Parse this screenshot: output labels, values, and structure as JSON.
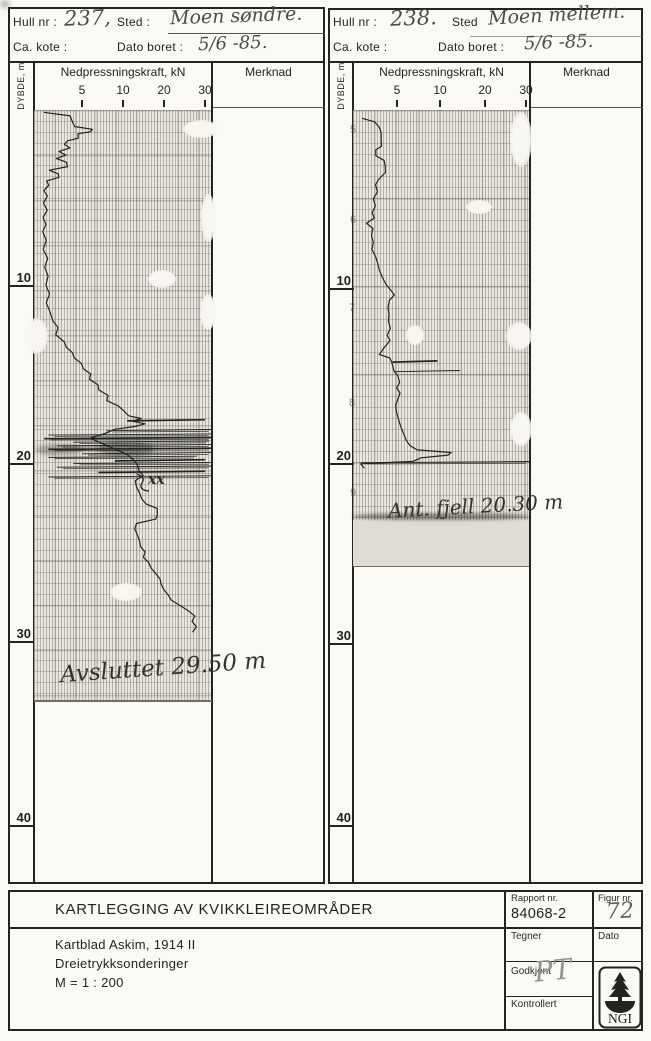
{
  "document": {
    "panels": [
      {
        "hull_label": "Hull nr :",
        "hull_value": "237,",
        "sted_label": "Sted :",
        "sted_value": "Moen søndre.",
        "kote_label": "Ca. kote :",
        "dato_label": "Dato boret :",
        "dato_value": "5/6 -85.",
        "depth_col_label": "DYBDE, m",
        "force_header": "Nedpressningskraft, kN",
        "merknad_header": "Merknad",
        "force_ticks": [
          "5",
          "10",
          "20",
          "30"
        ],
        "depth_labels": [
          "10",
          "20",
          "30",
          "40"
        ],
        "note": "xx",
        "end_annotation": "Avsluttet 29.50 m"
      },
      {
        "hull_label": "Hull nr :",
        "hull_value": "238.",
        "sted_label": "Sted",
        "sted_value": "Moen mellem.",
        "kote_label": "Ca. kote :",
        "dato_label": "Dato boret :",
        "dato_value": "5/6 -85.",
        "depth_col_label": "DYBDE, m",
        "force_header": "Nedpressningskraft, kN",
        "merknad_header": "Merknad",
        "force_ticks": [
          "5",
          "10",
          "20",
          "30"
        ],
        "depth_labels": [
          "10",
          "20",
          "30",
          "40"
        ],
        "paper_marks": [
          "5",
          "6",
          "7",
          "8",
          "9"
        ],
        "end_annotation": "Ant. fjell 20.30 m"
      }
    ],
    "title_block": {
      "title": "KARTLEGGING AV KVIKKLEIREOMRÅDER",
      "lines": [
        "Kartblad Askim, 1914 II",
        "Dreietrykksonderinger",
        "M = 1 : 200"
      ],
      "rapport_label": "Rapport nr.",
      "rapport_nr": "84068-2",
      "figur_label": "Figur nr.",
      "figur_nr": "72",
      "tegner_label": "Tegner",
      "dato_label": "Dato",
      "godkjent_label": "Godkjent",
      "godkjent_sign": "PT",
      "kontrollert_label": "Kontrollert",
      "logo_text": "NGI"
    }
  },
  "chart_data": [
    {
      "type": "line",
      "title": "Dreietrykksondering hull 237, Moen søndre",
      "xlabel": "Nedpressningskraft, kN",
      "ylabel": "Dybde, m",
      "x_ticks": [
        5,
        10,
        20,
        30
      ],
      "x_scale_note": "segmented scale, ticks 5/10/20/30 equally spaced",
      "depth_ticks": [
        10,
        20,
        30,
        40
      ],
      "ylim": [
        0,
        45
      ],
      "end_depth_m": 29.5,
      "end_note": "Avsluttet 29.50 m",
      "depth_m_force_kN": [
        [
          0.3,
          0.5
        ],
        [
          0.5,
          3.6
        ],
        [
          0.9,
          3.9
        ],
        [
          1.1,
          4.1
        ],
        [
          1.25,
          6.3
        ],
        [
          1.4,
          6.0
        ],
        [
          1.5,
          4.5
        ],
        [
          1.75,
          4.6
        ],
        [
          1.9,
          3.3
        ],
        [
          2.1,
          2.9
        ],
        [
          2.3,
          3.5
        ],
        [
          2.5,
          2.3
        ],
        [
          2.7,
          3.1
        ],
        [
          2.9,
          1.9
        ],
        [
          3.1,
          3.2
        ],
        [
          3.35,
          3.3
        ],
        [
          3.55,
          1.1
        ],
        [
          3.75,
          2.1
        ],
        [
          3.95,
          2.3
        ],
        [
          4.15,
          0.8
        ],
        [
          4.4,
          1.0
        ],
        [
          4.7,
          0.5
        ],
        [
          5.0,
          0.9
        ],
        [
          5.4,
          0.4
        ],
        [
          5.8,
          0.8
        ],
        [
          6.2,
          0.4
        ],
        [
          6.6,
          0.7
        ],
        [
          7.0,
          0.3
        ],
        [
          7.5,
          0.8
        ],
        [
          8.0,
          0.4
        ],
        [
          8.5,
          0.9
        ],
        [
          9.0,
          0.5
        ],
        [
          9.5,
          1.0
        ],
        [
          10.0,
          0.7
        ],
        [
          10.5,
          1.1
        ],
        [
          11.0,
          0.8
        ],
        [
          11.5,
          1.2
        ],
        [
          12.0,
          1.5
        ],
        [
          12.4,
          2.1
        ],
        [
          12.8,
          1.9
        ],
        [
          13.2,
          2.9
        ],
        [
          13.5,
          3.1
        ],
        [
          13.8,
          3.9
        ],
        [
          14.1,
          4.1
        ],
        [
          14.4,
          4.9
        ],
        [
          14.7,
          5.1
        ],
        [
          15.0,
          6.1
        ],
        [
          15.3,
          5.9
        ],
        [
          15.6,
          6.9
        ],
        [
          15.9,
          7.1
        ],
        [
          16.2,
          8.2
        ],
        [
          16.5,
          8.0
        ],
        [
          16.8,
          9.4
        ],
        [
          17.1,
          10.4
        ],
        [
          17.35,
          11.4
        ],
        [
          17.5,
          14.4
        ],
        [
          17.65,
          12.4
        ],
        [
          17.8,
          15.4
        ],
        [
          17.95,
          12.9
        ],
        [
          18.1,
          9.0
        ],
        [
          18.35,
          7.8
        ],
        [
          18.6,
          6.0
        ],
        [
          18.9,
          7.4
        ],
        [
          19.2,
          9.0
        ],
        [
          19.5,
          10.9
        ],
        [
          19.8,
          12.4
        ],
        [
          20.1,
          13.4
        ],
        [
          20.4,
          13.9
        ],
        [
          20.7,
          14.9
        ],
        [
          21.0,
          12.9
        ],
        [
          21.35,
          13.4
        ],
        [
          21.7,
          14.1
        ],
        [
          22.0,
          14.5
        ],
        [
          22.3,
          15.5
        ],
        [
          22.55,
          18.4
        ],
        [
          22.9,
          18.4
        ],
        [
          23.15,
          17.9
        ],
        [
          23.4,
          13.4
        ],
        [
          23.7,
          12.9
        ],
        [
          24.0,
          13.4
        ],
        [
          24.35,
          13.9
        ],
        [
          24.7,
          14.4
        ],
        [
          25.0,
          15.4
        ],
        [
          25.3,
          14.9
        ],
        [
          25.6,
          16.4
        ],
        [
          25.9,
          16.9
        ],
        [
          26.2,
          17.9
        ],
        [
          26.5,
          18.9
        ],
        [
          26.8,
          19.4
        ],
        [
          27.1,
          19.9
        ],
        [
          27.4,
          20.9
        ],
        [
          27.7,
          21.9
        ],
        [
          28.0,
          23.9
        ],
        [
          28.3,
          25.9
        ],
        [
          28.6,
          27.4
        ],
        [
          28.9,
          26.9
        ],
        [
          29.2,
          27.9
        ],
        [
          29.5,
          26.9
        ]
      ],
      "offscale_spikes": [
        [
          17.6,
          11,
          30
        ],
        [
          18.15,
          8,
          44
        ],
        [
          18.4,
          1,
          40
        ],
        [
          18.6,
          0.5,
          38
        ],
        [
          18.8,
          4,
          31
        ],
        [
          19.0,
          2,
          36
        ],
        [
          19.2,
          1,
          34
        ],
        [
          19.45,
          5,
          33
        ],
        [
          19.65,
          1,
          28
        ],
        [
          19.85,
          9,
          30
        ],
        [
          20.0,
          4,
          36
        ],
        [
          20.2,
          2,
          40
        ],
        [
          20.5,
          7,
          30
        ],
        [
          20.75,
          1,
          37
        ]
      ]
    },
    {
      "type": "line",
      "title": "Dreietrykksondering hull 238, Moen mellem",
      "xlabel": "Nedpressningskraft, kN",
      "ylabel": "Dybde, m",
      "x_ticks": [
        5,
        10,
        20,
        30
      ],
      "x_scale_note": "segmented scale, ticks 5/10/20/30 equally spaced",
      "depth_ticks": [
        10,
        20,
        30,
        40
      ],
      "ylim": [
        0,
        45
      ],
      "end_depth_m": 20.3,
      "end_note": "Ant. fjell 20.30 m",
      "depth_m_force_kN": [
        [
          0.3,
          1.0
        ],
        [
          0.5,
          2.4
        ],
        [
          0.8,
          2.9
        ],
        [
          1.1,
          3.1
        ],
        [
          1.5,
          3.2
        ],
        [
          1.9,
          3.2
        ],
        [
          2.1,
          2.5
        ],
        [
          2.45,
          2.6
        ],
        [
          2.7,
          3.5
        ],
        [
          3.0,
          3.6
        ],
        [
          3.4,
          3.6
        ],
        [
          3.8,
          2.9
        ],
        [
          4.1,
          2.5
        ],
        [
          4.5,
          2.7
        ],
        [
          4.9,
          2.3
        ],
        [
          5.3,
          2.5
        ],
        [
          5.7,
          2.1
        ],
        [
          6.0,
          2.3
        ],
        [
          6.3,
          1.5
        ],
        [
          6.6,
          2.2
        ],
        [
          7.0,
          2.0
        ],
        [
          7.4,
          2.3
        ],
        [
          7.8,
          2.1
        ],
        [
          8.2,
          2.5
        ],
        [
          8.6,
          2.7
        ],
        [
          9.0,
          3.0
        ],
        [
          9.4,
          3.3
        ],
        [
          9.8,
          3.7
        ],
        [
          10.1,
          4.3
        ],
        [
          10.4,
          4.7
        ],
        [
          10.7,
          4.1
        ],
        [
          11.1,
          3.9
        ],
        [
          11.5,
          4.1
        ],
        [
          11.9,
          4.0
        ],
        [
          12.3,
          4.2
        ],
        [
          12.7,
          3.9
        ],
        [
          13.0,
          4.2
        ],
        [
          13.4,
          3.5
        ],
        [
          13.8,
          2.9
        ],
        [
          14.0,
          4.2
        ],
        [
          14.25,
          4.4
        ],
        [
          14.5,
          4.5
        ],
        [
          14.75,
          4.7
        ],
        [
          15.0,
          5.1
        ],
        [
          15.4,
          5.3
        ],
        [
          15.7,
          4.9
        ],
        [
          16.0,
          5.4
        ],
        [
          16.35,
          5.1
        ],
        [
          16.7,
          4.8
        ],
        [
          17.1,
          5.0
        ],
        [
          17.5,
          5.2
        ],
        [
          17.9,
          5.4
        ],
        [
          18.3,
          5.7
        ],
        [
          18.7,
          6.1
        ],
        [
          19.0,
          6.5
        ],
        [
          19.25,
          7.3
        ],
        [
          19.4,
          12.6
        ],
        [
          19.55,
          11.8
        ],
        [
          19.7,
          7.8
        ],
        [
          19.9,
          6.8
        ],
        [
          20.05,
          0.8
        ],
        [
          20.3,
          1.2
        ]
      ],
      "offscale_spikes": [
        [
          14.2,
          4.5,
          9.7
        ],
        [
          14.75,
          4.7,
          14.4
        ],
        [
          19.95,
          0.8,
          31
        ]
      ]
    }
  ]
}
